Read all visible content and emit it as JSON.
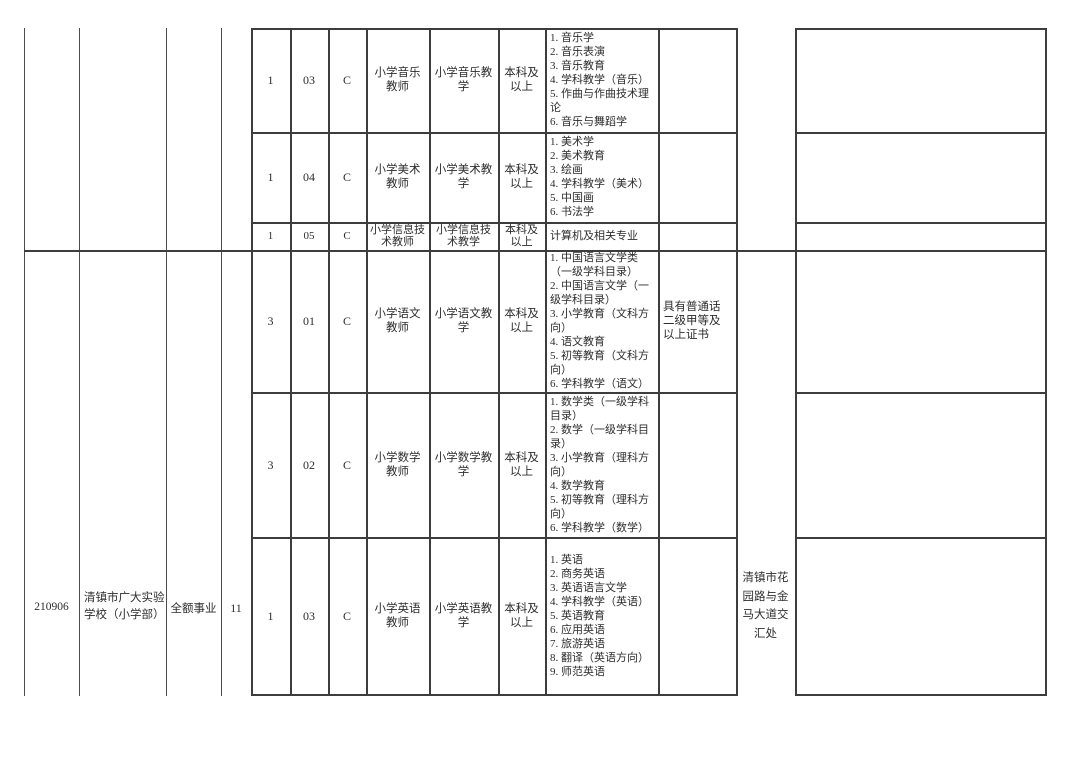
{
  "page": {
    "background": "#ffffff",
    "border_color": "#3d3d3d",
    "text_color": "#2d2d2d",
    "description": "Teacher recruitment position table (cropped view)"
  },
  "blocks": [
    {
      "unit_code": "",
      "unit_name": "",
      "unit_type": "",
      "total_positions": "",
      "address": "",
      "rows": [
        {
          "count": "1",
          "job_code": "03",
          "category": "C",
          "position_name": "小学音乐教师",
          "subject": "小学音乐教学",
          "education": "本科及以上",
          "majors": [
            "1. 音乐学",
            "2. 音乐表演",
            "3. 音乐教育",
            "4. 学科教学（音乐）",
            "5. 作曲与作曲技术理论",
            "6. 音乐与舞蹈学"
          ],
          "other_requirements": ""
        },
        {
          "count": "1",
          "job_code": "04",
          "category": "C",
          "position_name": "小学美术教师",
          "subject": "小学美术教学",
          "education": "本科及以上",
          "majors": [
            "1. 美术学",
            "2. 美术教育",
            "3. 绘画",
            "4. 学科教学（美术）",
            "5. 中国画",
            "6. 书法学"
          ],
          "other_requirements": ""
        },
        {
          "count": "1",
          "job_code": "05",
          "category": "C",
          "position_name": "小学信息技术教师",
          "subject": "小学信息技术教学",
          "education": "本科及以上",
          "majors": [
            "计算机及相关专业"
          ],
          "other_requirements": ""
        }
      ]
    },
    {
      "unit_code": "210906",
      "unit_name": "清镇市广大实验学校（小学部）",
      "unit_type": "全额事业",
      "total_positions": "11",
      "address": "清镇市花园路与金马大道交汇处",
      "rows": [
        {
          "count": "3",
          "job_code": "01",
          "category": "C",
          "position_name": "小学语文教师",
          "subject": "小学语文教学",
          "education": "本科及以上",
          "majors": [
            "1. 中国语言文学类（一级学科目录）",
            "2. 中国语言文学（一级学科目录）",
            "3. 小学教育（文科方向）",
            "4. 语文教育",
            "5. 初等教育（文科方向）",
            "6. 学科教学（语文）"
          ],
          "other_requirements": "具有普通话二级甲等及以上证书"
        },
        {
          "count": "3",
          "job_code": "02",
          "category": "C",
          "position_name": "小学数学教师",
          "subject": "小学数学教学",
          "education": "本科及以上",
          "majors": [
            "1. 数学类（一级学科目录）",
            "2. 数学（一级学科目录）",
            "3. 小学教育（理科方向）",
            "4. 数学教育",
            "5. 初等教育（理科方向）",
            "6. 学科教学（数学）"
          ],
          "other_requirements": ""
        },
        {
          "count": "1",
          "job_code": "03",
          "category": "C",
          "position_name": "小学英语教师",
          "subject": "小学英语教学",
          "education": "本科及以上",
          "majors": [
            "1. 英语",
            "2. 商务英语",
            "3. 英语语言文学",
            "4. 学科教学（英语）",
            "5. 英语教育",
            "6. 应用英语",
            "7. 旅游英语",
            "8. 翻译（英语方向）",
            "9. 师范英语"
          ],
          "other_requirements": ""
        }
      ]
    }
  ]
}
